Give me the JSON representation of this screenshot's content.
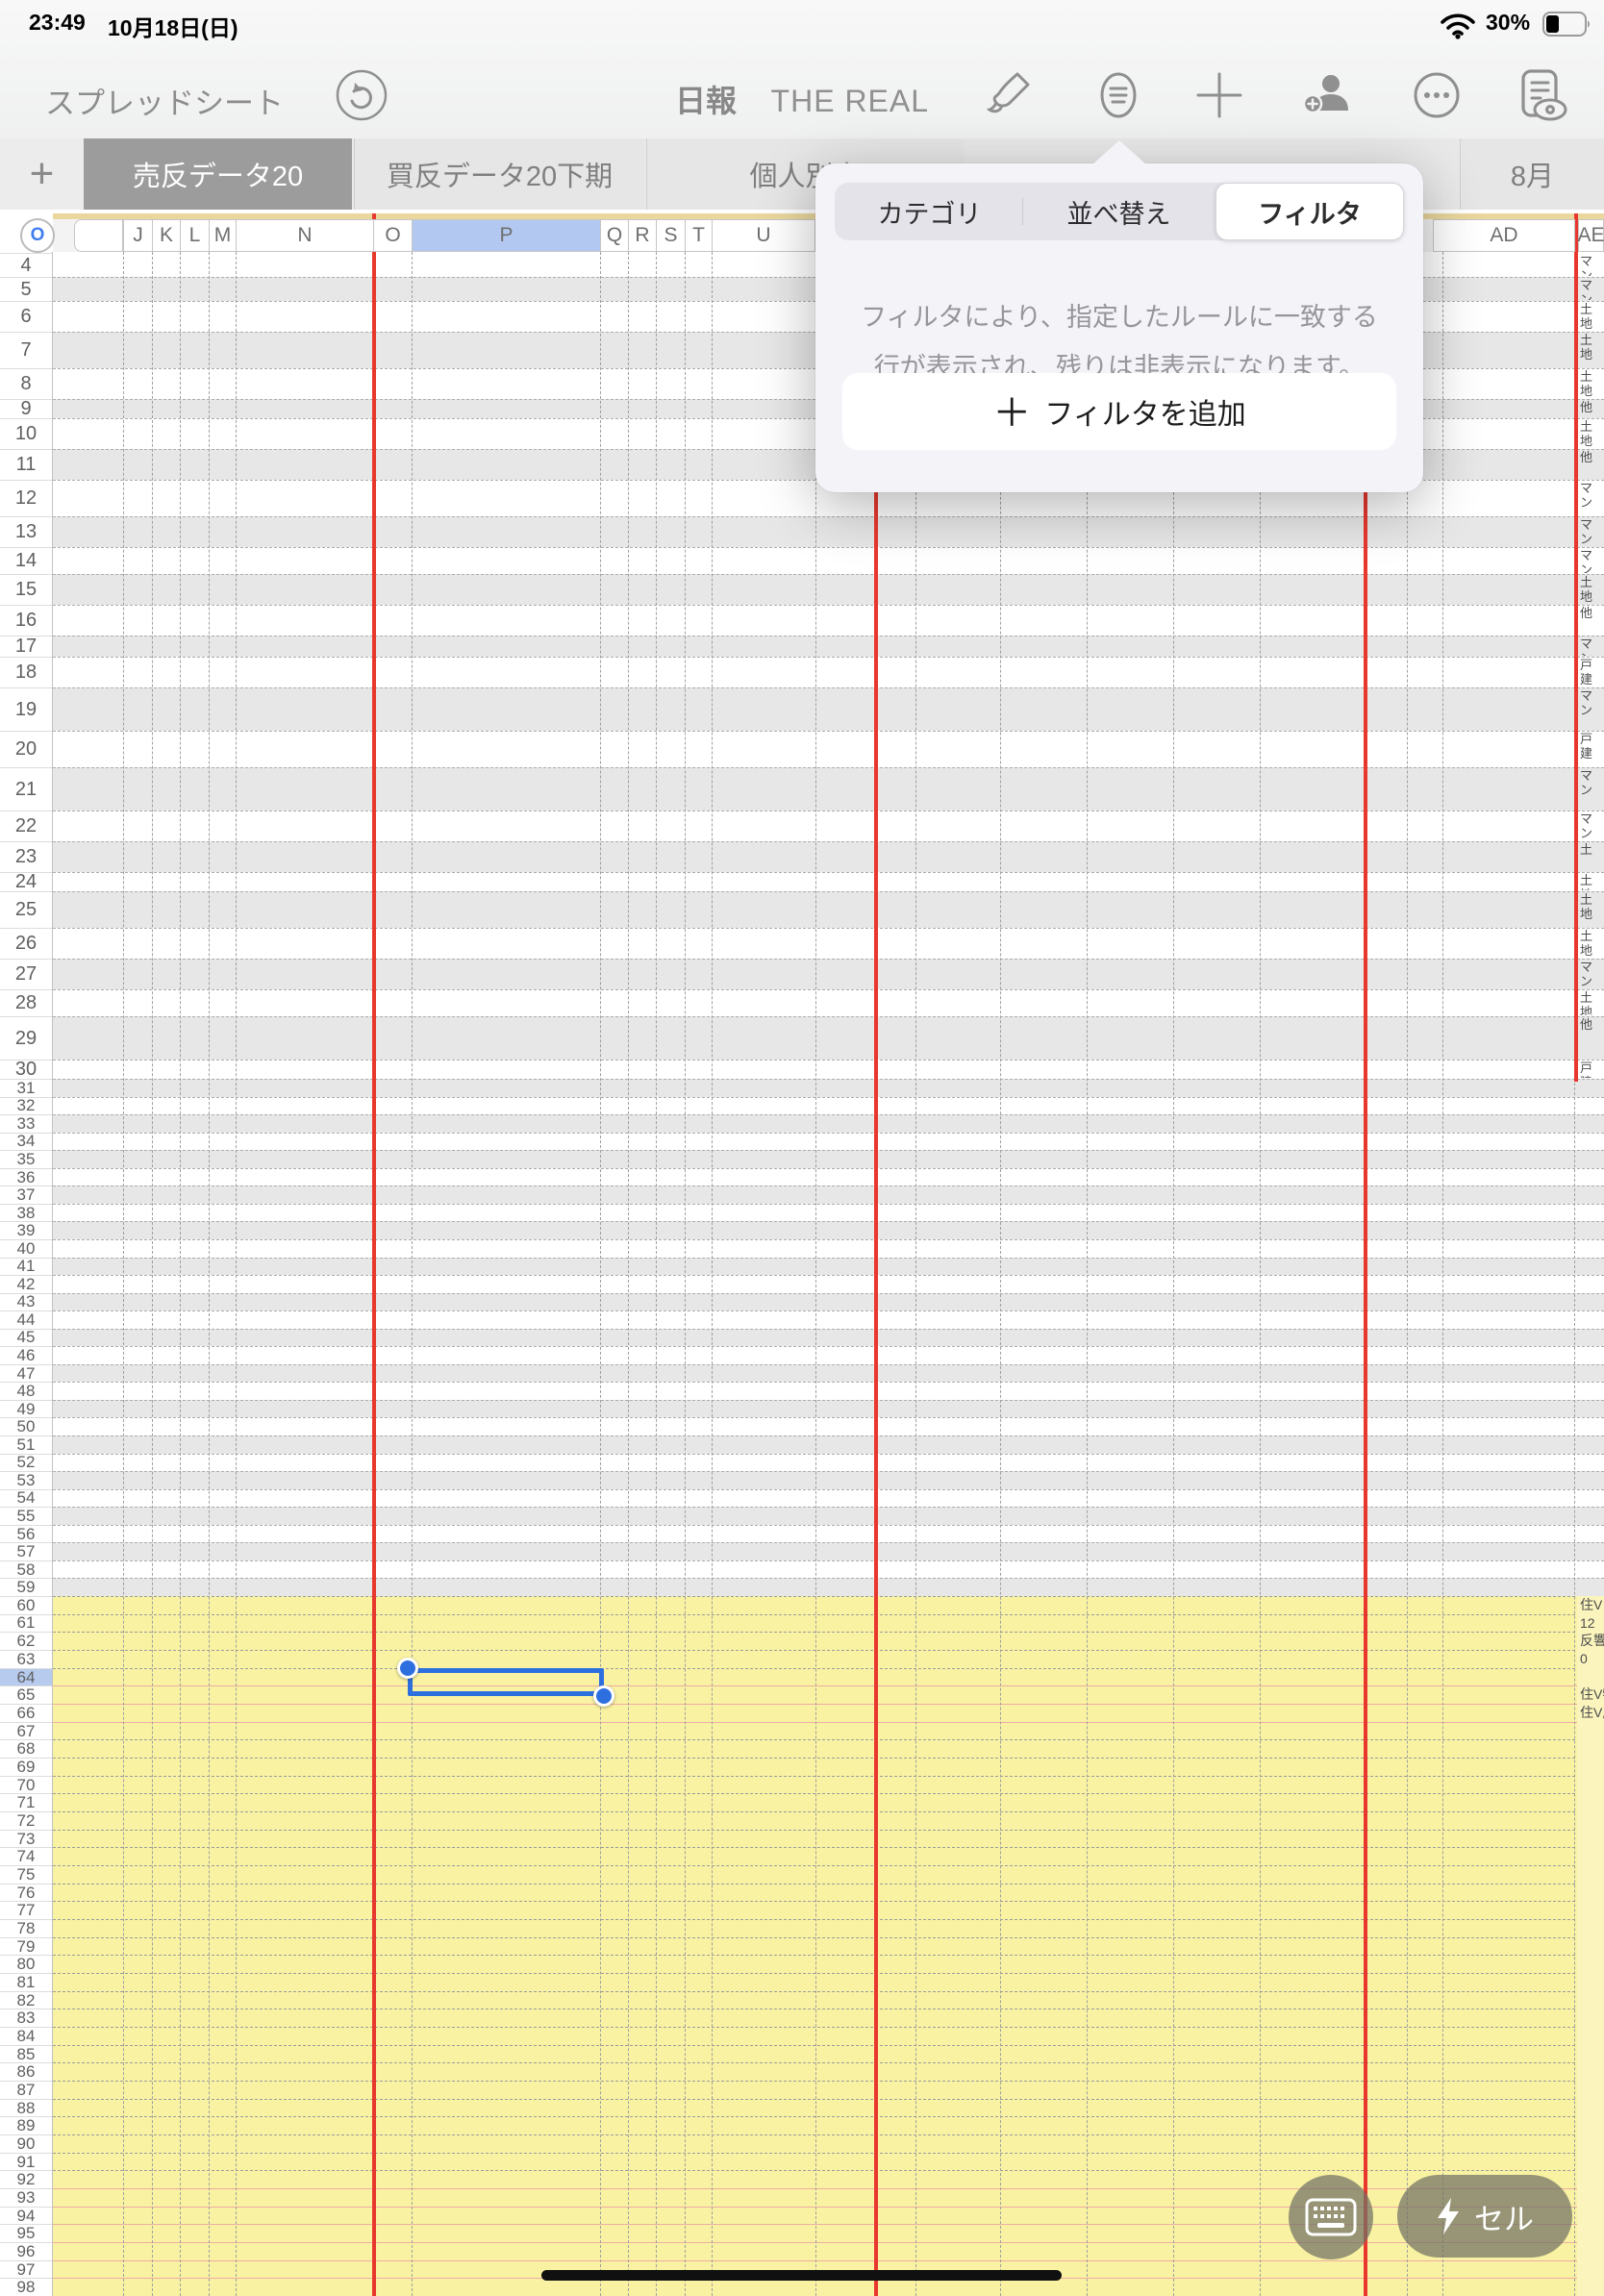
{
  "status_bar": {
    "time": "23:49",
    "date": "10月18日(日)",
    "battery_percent": "30%"
  },
  "toolbar": {
    "back_label": "スプレッドシート",
    "title": "日報",
    "subtitle": "THE REAL",
    "icons": [
      "undo-icon",
      "format-brush-icon",
      "organize-icon",
      "add-icon",
      "collaborate-icon",
      "more-icon",
      "view-options-icon"
    ]
  },
  "tab_bar": {
    "add_tab_glyph": "+",
    "tabs": [
      {
        "label": "売反データ20",
        "active": true
      },
      {
        "label": "買反データ20下期",
        "active": false
      },
      {
        "label": "個人別実",
        "active": false
      },
      {
        "label": "8月",
        "active": false
      }
    ]
  },
  "popover": {
    "segments": [
      {
        "label": "カテゴリ",
        "active": false
      },
      {
        "label": "並べ替え",
        "active": false
      },
      {
        "label": "フィルタ",
        "active": true
      }
    ],
    "description_line1": "フィルタにより、指定したルールに一致する",
    "description_line2": "行が表示され、残りは非表示になります。",
    "add_filter_plus": "＋",
    "add_filter_label": "フィルタを追加"
  },
  "sheet": {
    "select_all_label": "O",
    "column_headers": [
      "",
      "J",
      "K",
      "L",
      "M",
      "N",
      "O",
      "P",
      "Q",
      "R",
      "S",
      "T",
      "U",
      "AD",
      "AE"
    ],
    "selected_column": "P",
    "selected_row": 64,
    "first_row": 4,
    "last_row": 98,
    "ae_values_top_rows": [
      "マン",
      "マン",
      "土地",
      "土地",
      "土地",
      "他",
      "土地",
      "他",
      "マン",
      "マン",
      "マン",
      "土地",
      "他",
      "マン",
      "戸建",
      "マン",
      "戸建",
      "マン",
      "マン",
      "土",
      "土地",
      "土地",
      "土地",
      "マン",
      "土地",
      "他",
      "戸建"
    ],
    "ae_values_yellow_rows": {
      "60": "住V",
      "61": "12",
      "62": "反響",
      "63": "0",
      "65": "住V物",
      "66": "住V成"
    }
  },
  "bottom_bar": {
    "cell_button_label": "セル"
  },
  "colors": {
    "accent_blue": "#2e6fe0",
    "header_selected": "#b3c8f0",
    "red_guide": "#e8382e",
    "salmon_line": "#f0aca6",
    "yellow_area": "#f9f2a2",
    "yellow_ae": "#fbf5bd",
    "stripe_gray": "#e7e7e7",
    "active_tab": "#9c9c9c"
  }
}
